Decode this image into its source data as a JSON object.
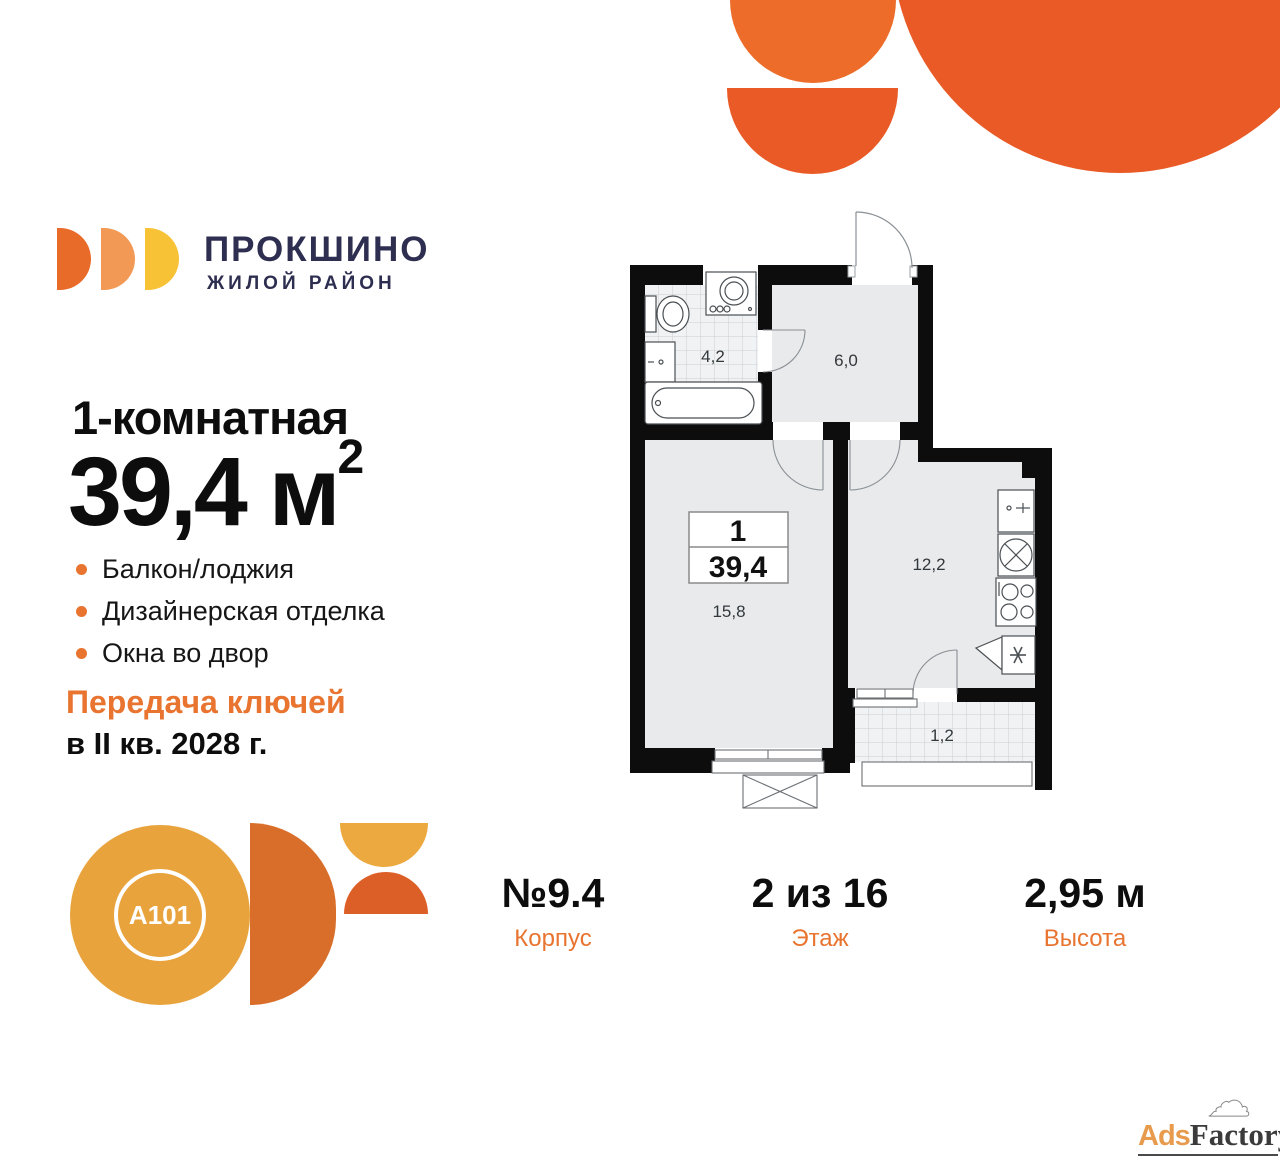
{
  "brand": {
    "name": "ПРОКШИНО",
    "subtitle": "ЖИЛОЙ РАЙОН",
    "colors": {
      "navy": "#2E2E50",
      "orange": "#E87430",
      "deco_orange": "#EA5A26",
      "logo_yellow": "#F7C235",
      "a101_gold": "#E8A33D"
    }
  },
  "offer": {
    "rooms_line": "1-комнатная",
    "area_value": "39,4 м",
    "area_sup": "2",
    "features": [
      "Балкон/лоджия",
      "Дизайнерская отделка",
      "Окна во двор"
    ],
    "handover_line1": "Передача ключей",
    "handover_line2": "в II кв. 2028 г."
  },
  "plan": {
    "flat_rooms_count": "1",
    "flat_area": "39,4",
    "rooms": [
      {
        "name": "bathroom",
        "area": "4,2"
      },
      {
        "name": "hallway",
        "area": "6,0"
      },
      {
        "name": "living-room",
        "area": "15,8"
      },
      {
        "name": "kitchen",
        "area": "12,2"
      },
      {
        "name": "balcony",
        "area": "1,2"
      }
    ]
  },
  "specs": [
    {
      "value": "№9.4",
      "label": "Корпус"
    },
    {
      "value": "2 из 16",
      "label": "Этаж"
    },
    {
      "value": "2,95 м",
      "label": "Высота"
    }
  ],
  "developer": {
    "logo_text": "A101"
  },
  "watermark": {
    "part1": "Ads",
    "part2": "Factory"
  }
}
